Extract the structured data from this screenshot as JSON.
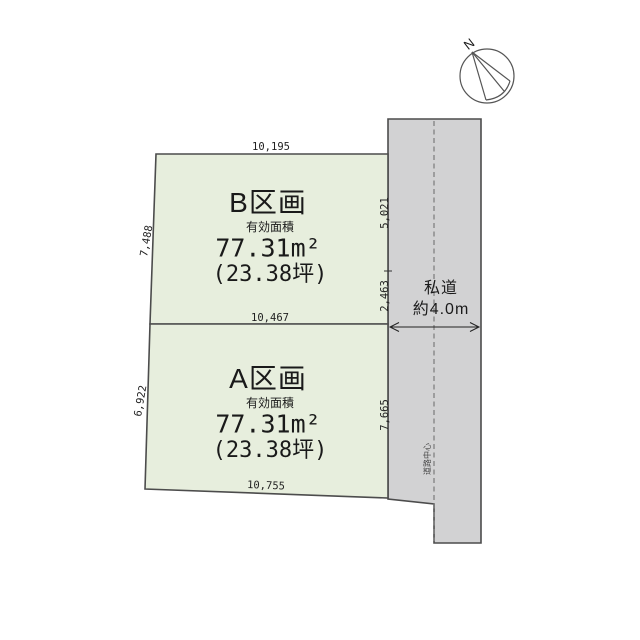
{
  "compass": {
    "label": "N"
  },
  "parcels": {
    "b": {
      "name": "B区画",
      "area_label": "有効面積",
      "area_m2": "77.31m²",
      "area_tsubo": "(23.38坪)",
      "dim_top": "10,195",
      "dim_left": "7,488",
      "dim_right_upper": "5,021",
      "dim_right_lower": "2,463"
    },
    "a": {
      "name": "A区画",
      "area_label": "有効面積",
      "area_m2": "77.31m²",
      "area_tsubo": "(23.38坪)",
      "dim_top": "10,467",
      "dim_left": "6,922",
      "dim_right": "7,665",
      "dim_bottom": "10,755"
    }
  },
  "road": {
    "name": "私道",
    "width_label": "約4.0m",
    "centerline_label": "道路中心"
  },
  "colors": {
    "parcel_fill": "#e7eedd",
    "road_fill": "#d2d2d3",
    "line": "#4c4c4c"
  }
}
